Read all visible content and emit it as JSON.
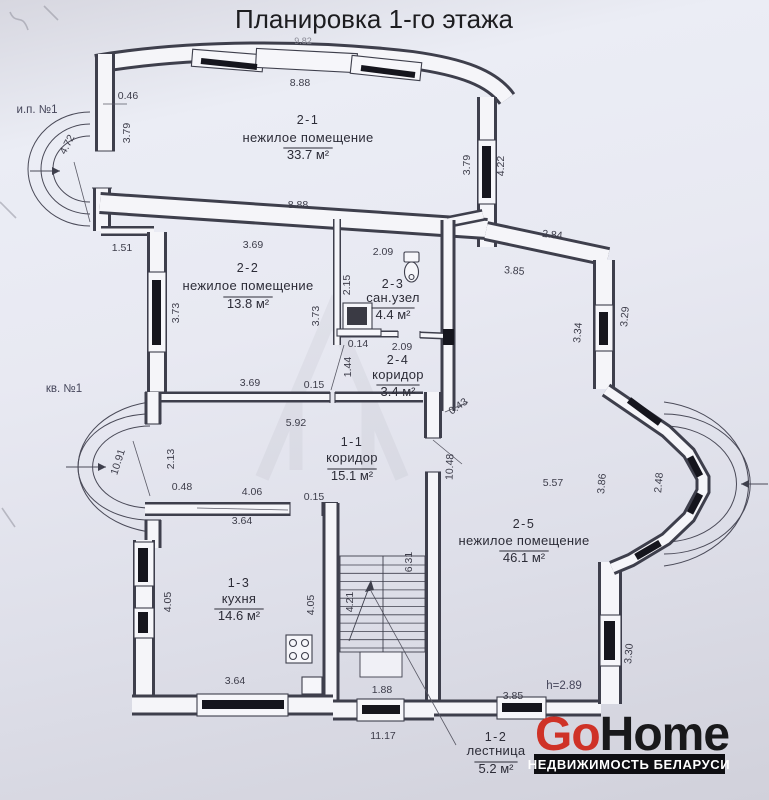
{
  "title": "Планировка 1-го этажа",
  "annotations": {
    "plot_label_top": "и.п. №1",
    "plot_label_left": "кв. №1",
    "ceiling_height": "h=2.89"
  },
  "rooms": [
    {
      "id": "2-1",
      "name": "нежилое помещение",
      "area": "33.7 м²",
      "cx": 308,
      "idY": 124,
      "nameY": 142,
      "areaY": 159
    },
    {
      "id": "2-2",
      "name": "нежилое помещение",
      "area": "13.8 м²",
      "cx": 248,
      "idY": 272,
      "nameY": 290,
      "areaY": 308
    },
    {
      "id": "2-3",
      "name": "сан.узел",
      "area": "4.4 м²",
      "cx": 393,
      "idY": 288,
      "nameY": 302,
      "areaY": 319
    },
    {
      "id": "2-4",
      "name": "коридор",
      "area": "3.4 м²",
      "cx": 398,
      "idY": 364,
      "nameY": 379,
      "areaY": 396
    },
    {
      "id": "1-1",
      "name": "коридор",
      "area": "15.1 м²",
      "cx": 352,
      "idY": 446,
      "nameY": 462,
      "areaY": 480
    },
    {
      "id": "2-5",
      "name": "нежилое помещение",
      "area": "46.1 м²",
      "cx": 524,
      "idY": 528,
      "nameY": 545,
      "areaY": 562
    },
    {
      "id": "1-3",
      "name": "кухня",
      "area": "14.6 м²",
      "cx": 239,
      "idY": 587,
      "nameY": 603,
      "areaY": 620
    },
    {
      "id": "1-2",
      "name": "лестница",
      "area": "5.2 м²",
      "cx": 496,
      "idY": 741,
      "nameY": 755,
      "areaY": 773
    }
  ],
  "dimensions": [
    {
      "v": "9.82",
      "x": 303,
      "y": 44,
      "r": 0,
      "cls": "faint"
    },
    {
      "v": "8.88",
      "x": 300,
      "y": 86,
      "r": 0
    },
    {
      "v": "0.46",
      "x": 128,
      "y": 99,
      "r": 0
    },
    {
      "v": "3.79",
      "x": 130,
      "y": 133,
      "r": -90
    },
    {
      "v": "4.72",
      "x": 70,
      "y": 146,
      "r": -62
    },
    {
      "v": "3.79",
      "x": 470,
      "y": 165,
      "r": -90
    },
    {
      "v": "4.22",
      "x": 504,
      "y": 166,
      "r": -90
    },
    {
      "v": "8.88",
      "x": 298,
      "y": 208,
      "r": 0
    },
    {
      "v": "1.51",
      "x": 122,
      "y": 251,
      "r": 0
    },
    {
      "v": "2.84",
      "x": 552,
      "y": 238,
      "r": 6
    },
    {
      "v": "3.85",
      "x": 514,
      "y": 274,
      "r": 5
    },
    {
      "v": "3.69",
      "x": 253,
      "y": 248,
      "r": 0
    },
    {
      "v": "2.09",
      "x": 383,
      "y": 255,
      "r": 0
    },
    {
      "v": "2.15",
      "x": 350,
      "y": 285,
      "r": -90
    },
    {
      "v": "3.73",
      "x": 179,
      "y": 313,
      "r": -90
    },
    {
      "v": "3.73",
      "x": 319,
      "y": 316,
      "r": -90
    },
    {
      "v": "3.34",
      "x": 581,
      "y": 333,
      "r": -85
    },
    {
      "v": "3.29",
      "x": 628,
      "y": 317,
      "r": -85
    },
    {
      "v": "0.14",
      "x": 358,
      "y": 347,
      "r": 0
    },
    {
      "v": "2.09",
      "x": 402,
      "y": 350,
      "r": 0
    },
    {
      "v": "1.44",
      "x": 351,
      "y": 367,
      "r": -90
    },
    {
      "v": "3.69",
      "x": 250,
      "y": 386,
      "r": 0
    },
    {
      "v": "0.15",
      "x": 314,
      "y": 388,
      "r": 0
    },
    {
      "v": "5.92",
      "x": 296,
      "y": 426,
      "r": 0
    },
    {
      "v": "0.43",
      "x": 460,
      "y": 409,
      "r": -35
    },
    {
      "v": "2.13",
      "x": 174,
      "y": 459,
      "r": -90
    },
    {
      "v": "10.91",
      "x": 121,
      "y": 463,
      "r": -72
    },
    {
      "v": "10.48",
      "x": 453,
      "y": 467,
      "r": -88
    },
    {
      "v": "5.57",
      "x": 553,
      "y": 486,
      "r": 0
    },
    {
      "v": "3.86",
      "x": 605,
      "y": 484,
      "r": -85
    },
    {
      "v": "2.48",
      "x": 662,
      "y": 483,
      "r": -85
    },
    {
      "v": "0.48",
      "x": 182,
      "y": 490,
      "r": 0
    },
    {
      "v": "4.06",
      "x": 252,
      "y": 495,
      "r": 0
    },
    {
      "v": "0.15",
      "x": 314,
      "y": 500,
      "r": 0
    },
    {
      "v": "3.64",
      "x": 242,
      "y": 524,
      "r": 0
    },
    {
      "v": "6.31",
      "x": 412,
      "y": 562,
      "r": -90
    },
    {
      "v": "4.05",
      "x": 171,
      "y": 602,
      "r": -90
    },
    {
      "v": "4.21",
      "x": 353,
      "y": 602,
      "r": -90
    },
    {
      "v": "4.05",
      "x": 314,
      "y": 605,
      "r": -90
    },
    {
      "v": "3.64",
      "x": 235,
      "y": 684,
      "r": 0
    },
    {
      "v": "1.88",
      "x": 382,
      "y": 693,
      "r": 0
    },
    {
      "v": "11.17",
      "x": 383,
      "y": 739,
      "r": 0
    },
    {
      "v": "3.85",
      "x": 513,
      "y": 699,
      "r": 0
    },
    {
      "v": "3.30",
      "x": 632,
      "y": 654,
      "r": -85
    }
  ],
  "logo": {
    "go": "Go",
    "home": "Home",
    "tagline": "НЕДВИЖИМОСТЬ БЕЛАРУСИ",
    "go_color": "#cf3227",
    "home_color": "#19191b",
    "bar_color": "#0e0e12",
    "tagline_color": "#ffffff"
  }
}
